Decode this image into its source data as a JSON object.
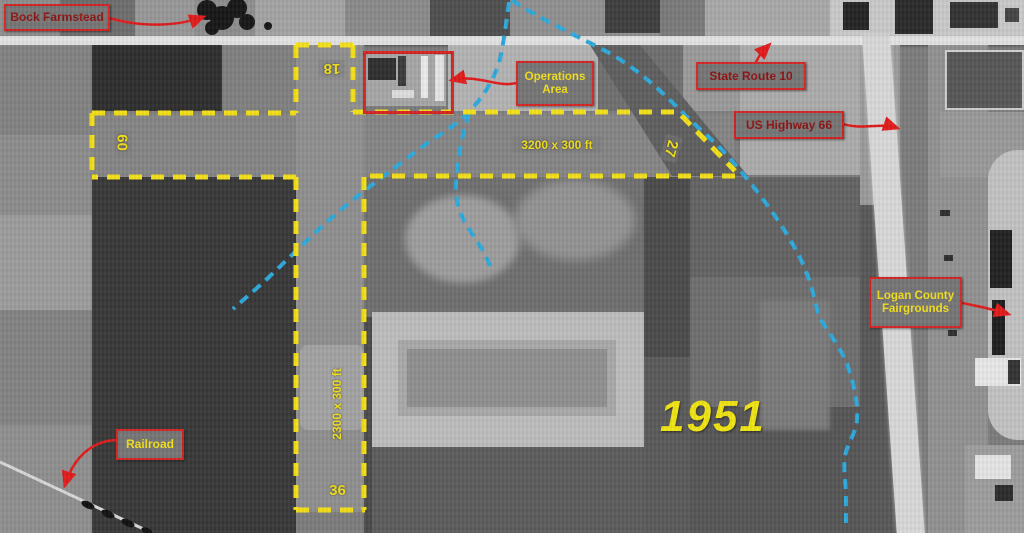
{
  "annotations": {
    "bock_farmstead": {
      "label": "Bock Farmstead"
    },
    "operations_area": {
      "line1": "Operations",
      "line2": "Area"
    },
    "state_route_10": {
      "label": "State Route 10"
    },
    "us_highway_66": {
      "label": "US Highway 66"
    },
    "logan_county_fairgrounds": {
      "line1": "Logan County",
      "line2": "Fairgrounds"
    },
    "railroad": {
      "label": "Railroad"
    },
    "year_overlay": {
      "label": "1951"
    }
  },
  "runways": {
    "east_west": {
      "dimension_label": "3200 x 300 ft",
      "west_end_number": "09",
      "east_end_number": "27"
    },
    "north_south": {
      "dimension_label": "2300 x 300 ft",
      "north_end_number": "18",
      "south_end_number": "36"
    }
  },
  "colors": {
    "runway_outline_yellow": "#f3df17",
    "creek_blue": "#2da9dc",
    "annotation_red": "#d42222",
    "label_box_background": "#757575",
    "label_text_yellow": "#f2df1c",
    "label_text_dark_red": "#8e1313"
  }
}
